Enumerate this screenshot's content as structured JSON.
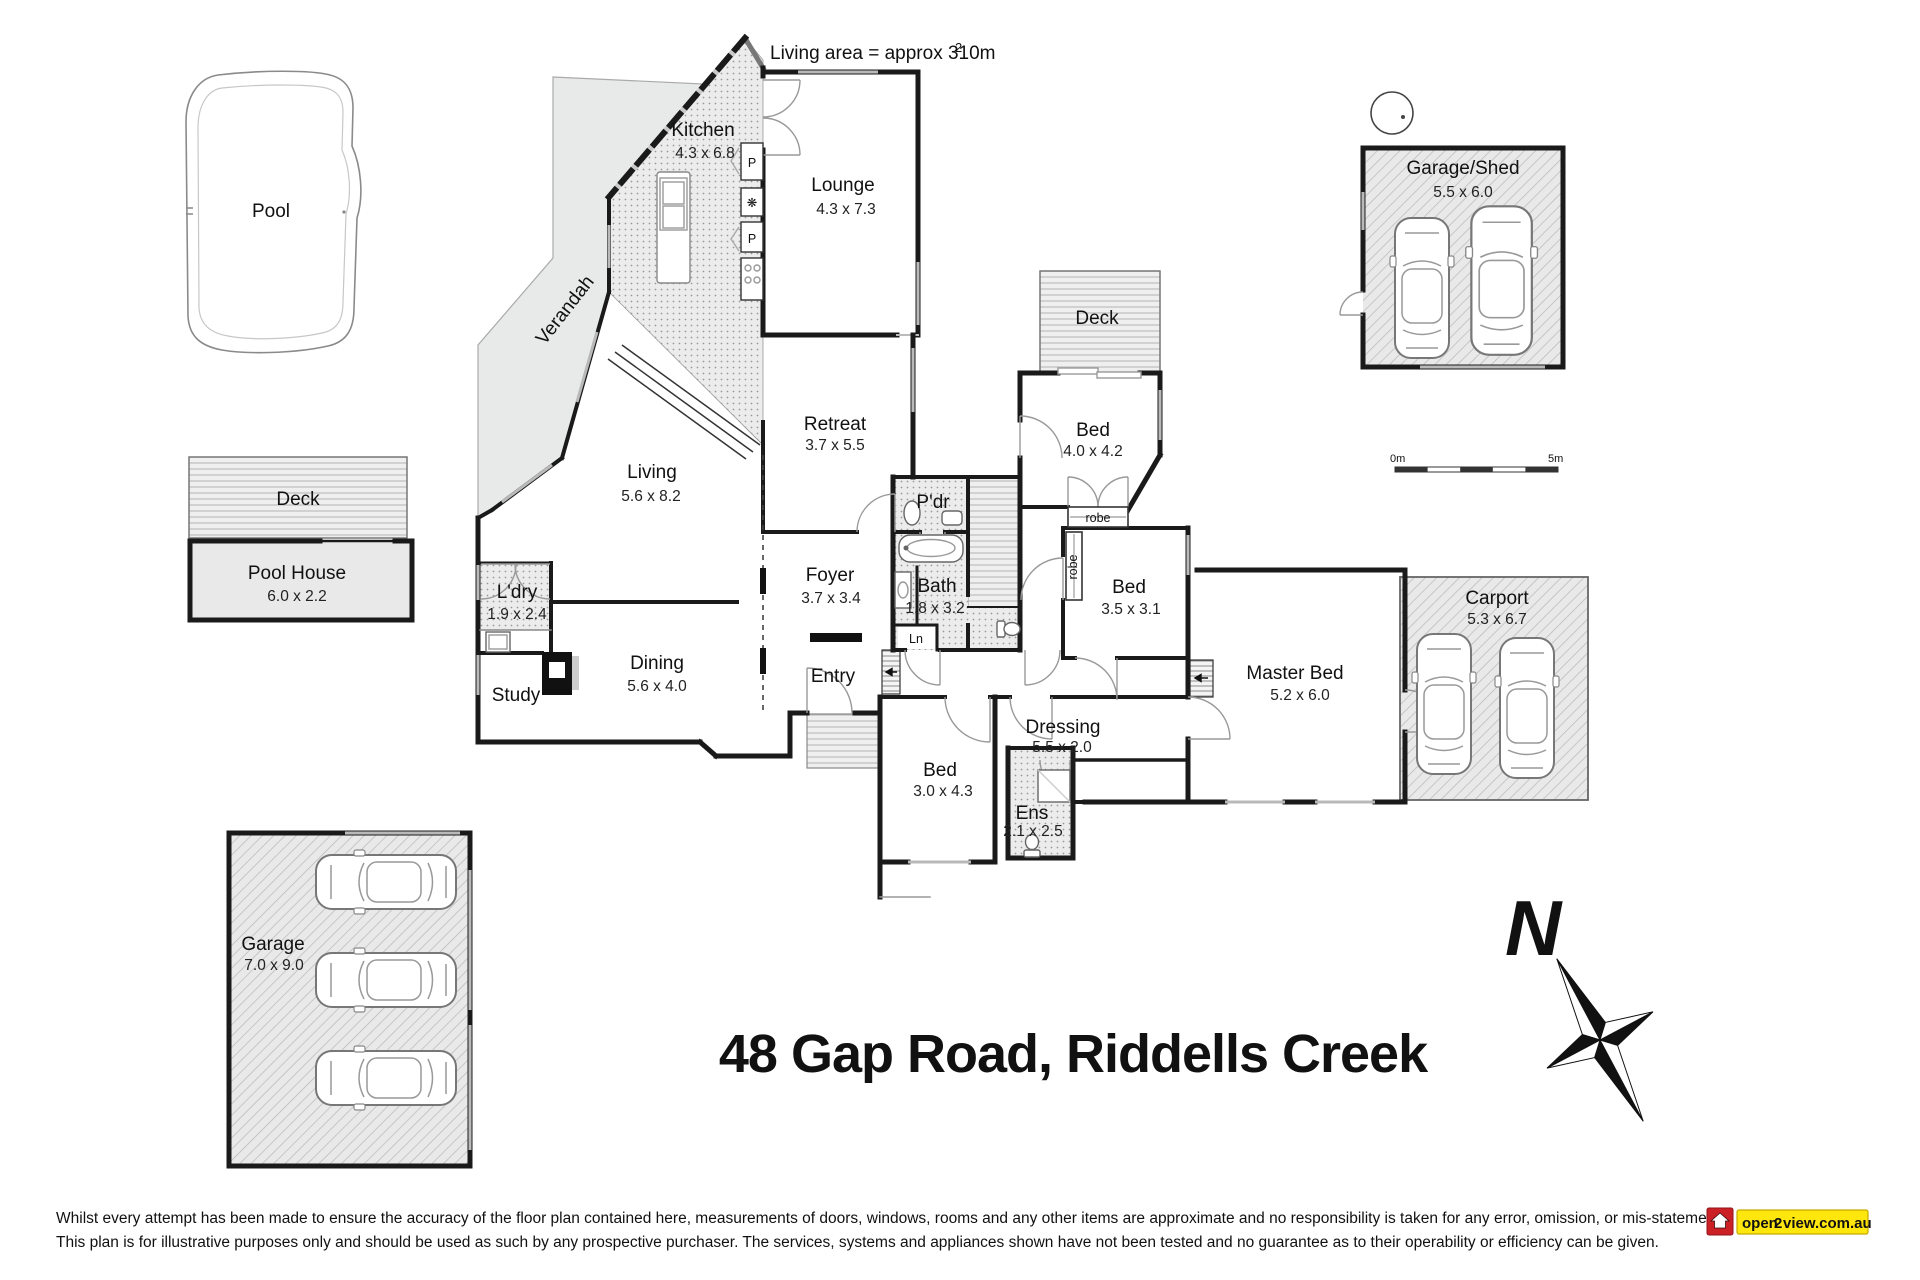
{
  "annotations": {
    "living_area_note": "Living area = approx 310m",
    "living_area_sup": "2"
  },
  "title": "48 Gap Road, Riddells Creek",
  "rooms": {
    "kitchen": {
      "name": "Kitchen",
      "dim": "4.3 x 6.8"
    },
    "lounge": {
      "name": "Lounge",
      "dim": "4.3 x 7.3"
    },
    "deck_top": {
      "name": "Deck"
    },
    "bed1": {
      "name": "Bed",
      "dim": "4.0 x 4.2"
    },
    "retreat": {
      "name": "Retreat",
      "dim": "3.7 x 5.5"
    },
    "living": {
      "name": "Living",
      "dim": "5.6 x 8.2"
    },
    "pdr": {
      "name": "P'dr"
    },
    "bath": {
      "name": "Bath",
      "dim": "1.8 x 3.2"
    },
    "robe_h": {
      "name": "robe"
    },
    "robe_v": {
      "name": "robe"
    },
    "bed2": {
      "name": "Bed",
      "dim": "3.5 x 3.1"
    },
    "ldry": {
      "name": "L'dry",
      "dim": "1.9 x 2.4"
    },
    "foyer": {
      "name": "Foyer",
      "dim": "3.7 x 3.4"
    },
    "ln": {
      "name": "Ln"
    },
    "study": {
      "name": "Study"
    },
    "dining": {
      "name": "Dining",
      "dim": "5.6 x 4.0"
    },
    "entry": {
      "name": "Entry"
    },
    "master": {
      "name": "Master Bed",
      "dim": "5.2 x 6.0"
    },
    "dressing": {
      "name": "Dressing",
      "dim": "5.5 x 2.0"
    },
    "bed3": {
      "name": "Bed",
      "dim": "3.0 x 4.3"
    },
    "ens": {
      "name": "Ens",
      "dim": "2.1 x 2.5"
    },
    "carport": {
      "name": "Carport",
      "dim": "5.3 x 6.7"
    },
    "garage_shed": {
      "name": "Garage/Shed",
      "dim": "5.5 x 6.0"
    },
    "garage": {
      "name": "Garage",
      "dim": "7.0 x 9.0"
    },
    "pool": {
      "name": "Pool"
    },
    "deck_left": {
      "name": "Deck"
    },
    "pool_house": {
      "name": "Pool House",
      "dim": "6.0 x 2.2"
    },
    "verandah": {
      "name": "Verandah"
    }
  },
  "appliances": {
    "pantry1": "P",
    "pantry2": "P"
  },
  "scale_bar": {
    "start": "0m",
    "end": "5m"
  },
  "compass": {
    "north": "N"
  },
  "disclaimer": {
    "line1": "Whilst every attempt has been made to ensure the accuracy of the floor plan contained here, measurements of doors, windows, rooms and any other items are approximate and no responsibility is taken for any error, omission, or mis-statement.",
    "line2": "This plan is for illustrative purposes only and should be used as such by any prospective purchaser. The services, systems and appliances shown have not been tested and no guarantee as to their operability or efficiency can be given."
  },
  "logo": {
    "part1": "open",
    "part2": "2",
    "part3": "view.com.au"
  },
  "colors": {
    "wall": "#1a1a1a",
    "window": "#b9b9b9",
    "logo_red": "#cc2027",
    "logo_yellow": "#ffe60d"
  }
}
